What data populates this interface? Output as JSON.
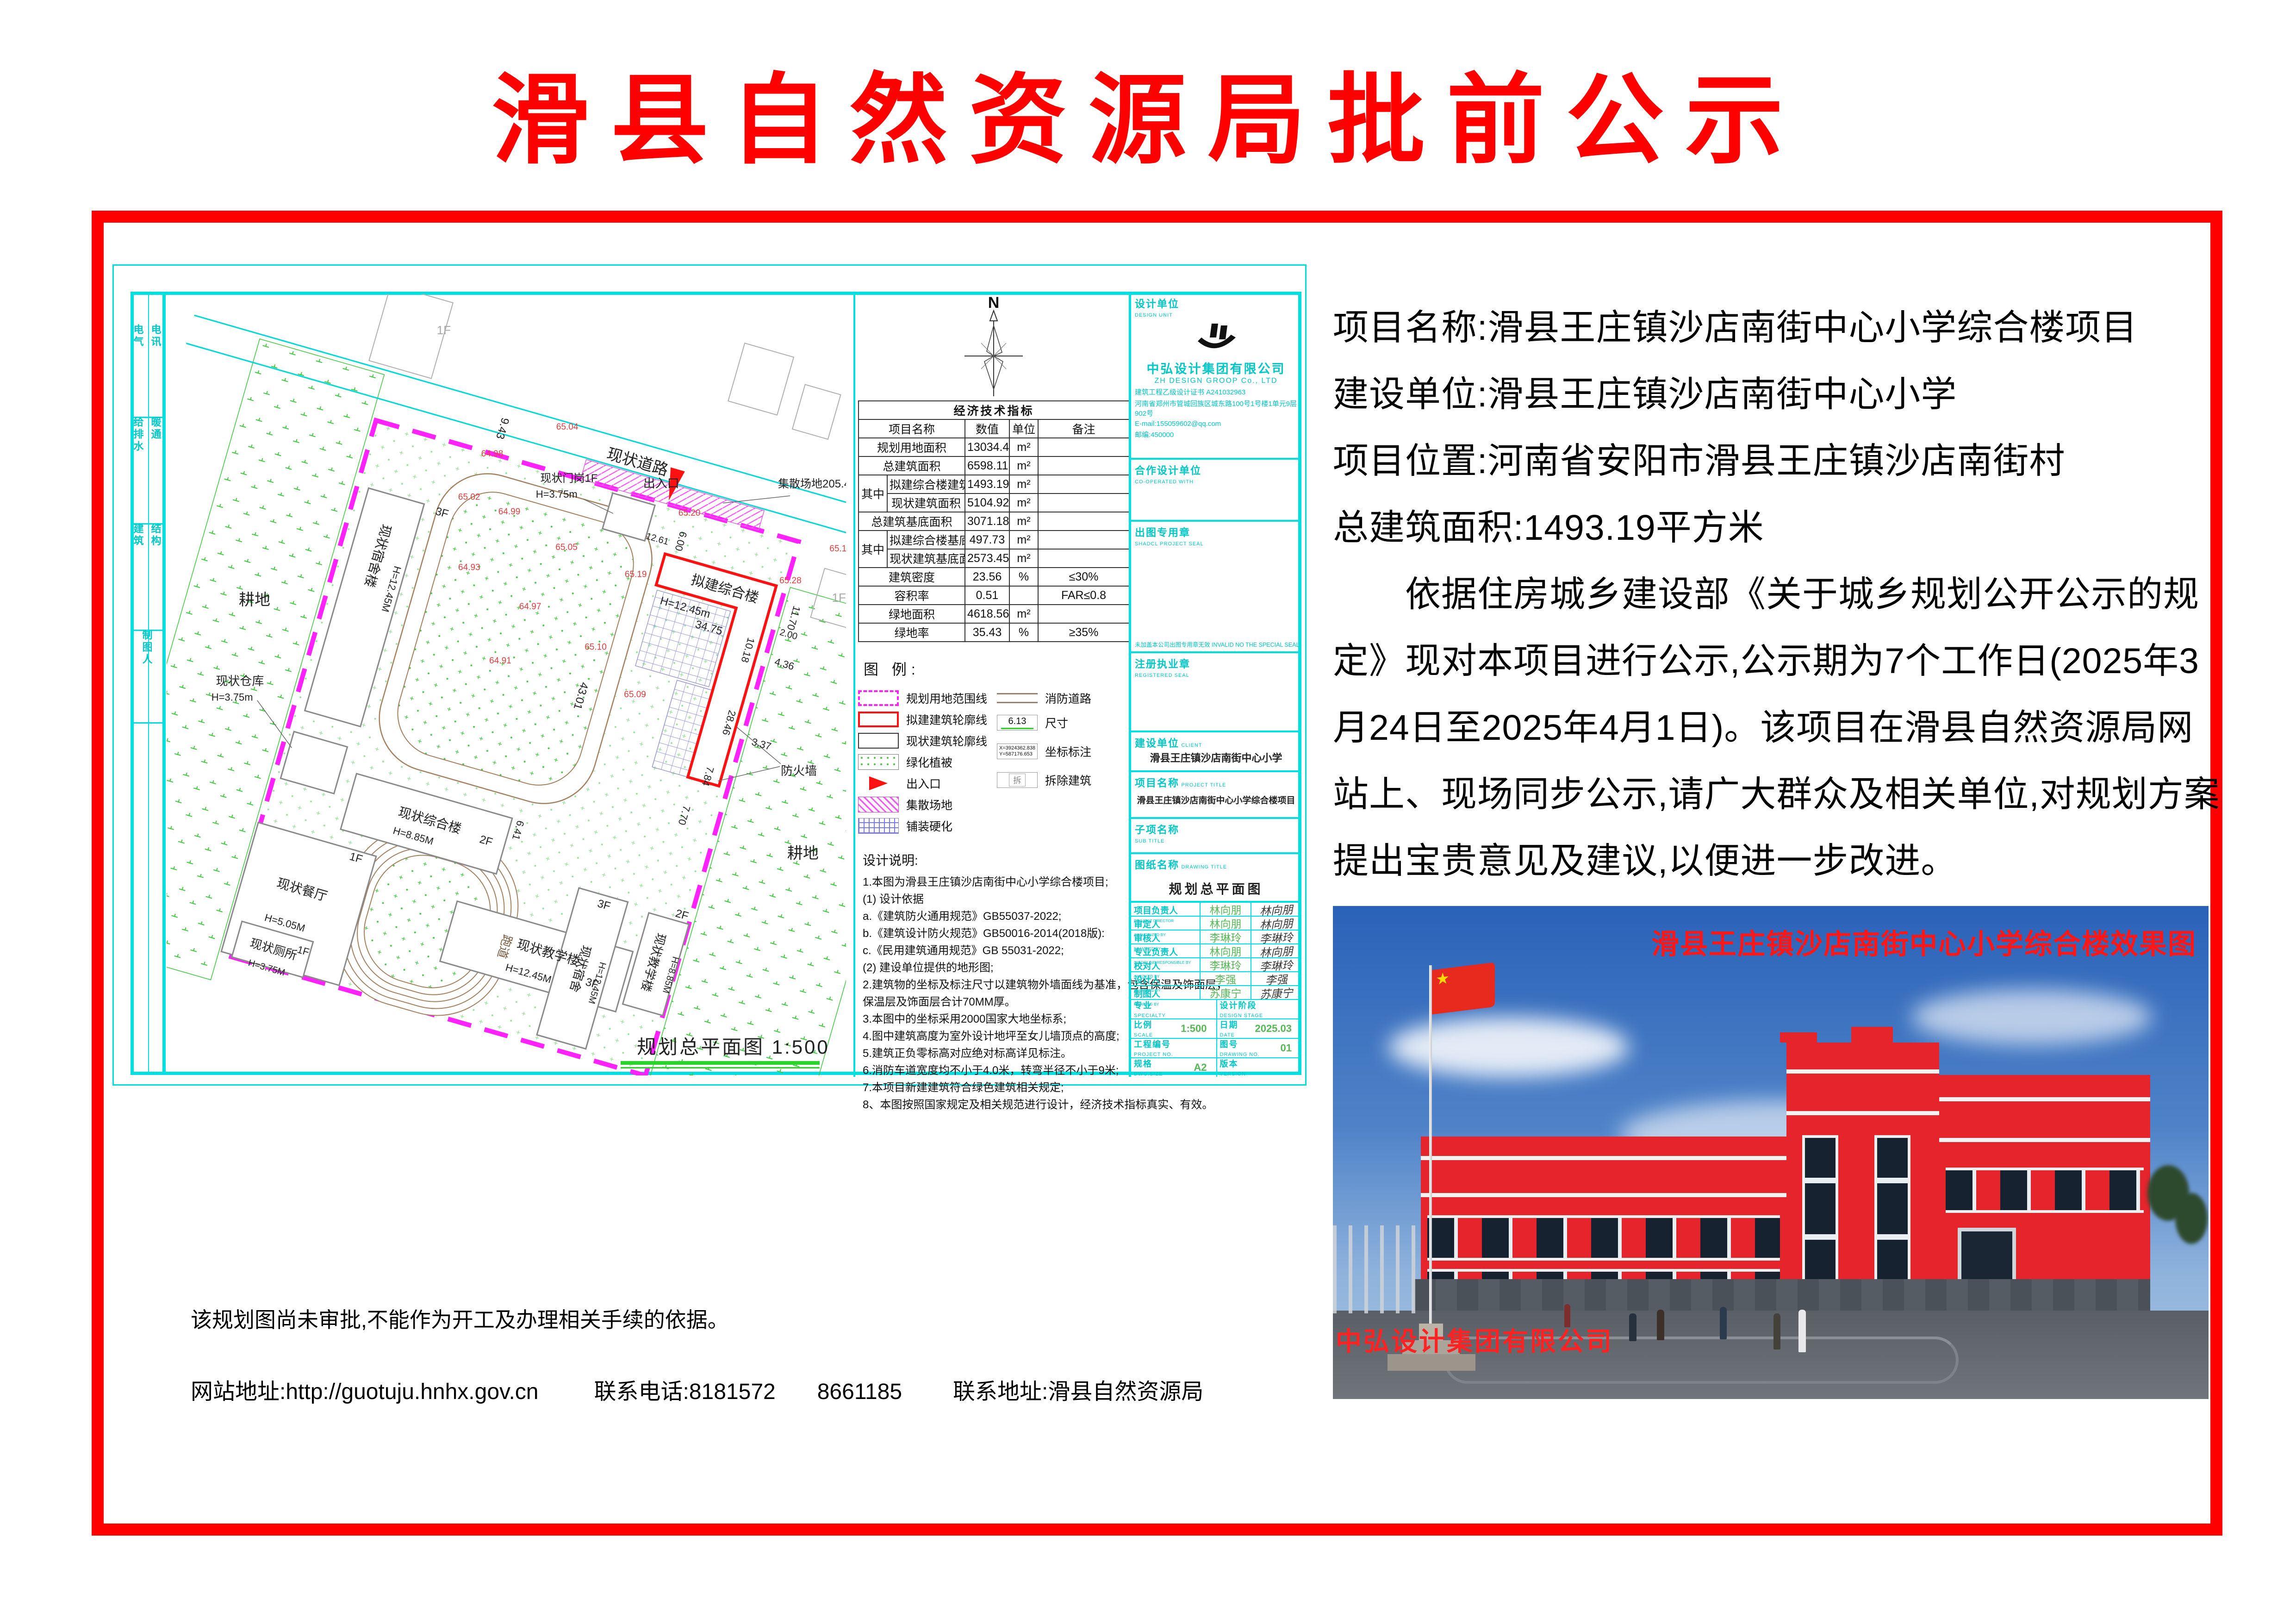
{
  "page": {
    "title": "滑县自然资源局批前公示"
  },
  "info": {
    "lines": [
      "项目名称:滑县王庄镇沙店南街中心小学综合楼项目",
      "建设单位:滑县王庄镇沙店南街中心小学",
      "项目位置:河南省安阳市滑县王庄镇沙店南街村",
      "总建筑面积:1493.19平方米",
      "　　依据住房城乡建设部《关于城乡规划公开公示的规",
      "定》现对本项目进行公示,公示期为7个工作日(2025年3",
      "月24日至2025年4月1日)。该项目在滑县自然资源局网",
      "站上、现场同步公示,请广大群众及相关单位,对规划方案",
      "提出宝贵意见及建议,以便进一步改进。"
    ]
  },
  "footer": {
    "disclaimer": "该规划图尚未审批,不能作为开工及办理相关手续的依据。",
    "website": "网站地址:http://guotuju.hnhx.gov.cn",
    "phone": "联系电话:8181572",
    "phone2": "8661185",
    "address": "联系地址:滑县自然资源局"
  },
  "sheet": {
    "side": {
      "a1": "电气",
      "a2": "电讯",
      "b1": "给排水",
      "b2": "暖通",
      "c1": "建筑",
      "c2": "结构",
      "d": "制图人"
    },
    "compass_n": "N",
    "table": {
      "title": "经济技术指标",
      "headers": {
        "name": "项目名称",
        "value": "数值",
        "unit": "单位",
        "note": "备注"
      },
      "rows": [
        {
          "group": "",
          "name": "规划用地面积",
          "value": "13034.49",
          "unit": "m²",
          "note": ""
        },
        {
          "group": "",
          "name": "总建筑面积",
          "value": "6598.11",
          "unit": "m²",
          "note": ""
        },
        {
          "group": "其中",
          "name": "拟建综合楼建筑面积",
          "value": "1493.19",
          "unit": "m²",
          "note": ""
        },
        {
          "group": "其中",
          "name": "现状建筑面积",
          "value": "5104.92",
          "unit": "m²",
          "note": ""
        },
        {
          "group": "",
          "name": "总建筑基底面积",
          "value": "3071.18",
          "unit": "m²",
          "note": ""
        },
        {
          "group": "其中",
          "name": "拟建综合楼基底面积",
          "value": "497.73",
          "unit": "m²",
          "note": ""
        },
        {
          "group": "其中",
          "name": "现状建筑基底面积",
          "value": "2573.45",
          "unit": "m²",
          "note": ""
        },
        {
          "group": "",
          "name": "建筑密度",
          "value": "23.56",
          "unit": "%",
          "note": "≤30%"
        },
        {
          "group": "",
          "name": "容积率",
          "value": "0.51",
          "unit": "",
          "note": "FAR≤0.8"
        },
        {
          "group": "",
          "name": "绿地面积",
          "value": "4618.56",
          "unit": "m²",
          "note": ""
        },
        {
          "group": "",
          "name": "绿地率",
          "value": "35.43",
          "unit": "%",
          "note": "≥35%"
        }
      ]
    },
    "legend": {
      "title": "图 例:",
      "l1": "规划用地范围线",
      "l2": "拟建建筑轮廓线",
      "l3": "现状建筑轮廓线",
      "l4": "绿化植被",
      "l5": "出入口",
      "l6": "集散场地",
      "l7": "铺装硬化",
      "r1": "消防道路",
      "r2": "尺寸",
      "r2v": "6.13",
      "r3": "坐标标注",
      "r3x": "X=3924362.838",
      "r3y": "Y=587176.653",
      "r4": "拆除建筑",
      "r4s": "拆"
    },
    "notes": {
      "title": "设计说明:",
      "lines": [
        "1.本图为滑县王庄镇沙店南街中心小学综合楼项目;",
        "(1) 设计依据",
        "a.《建筑防火通用规范》GB55037-2022;",
        "b.《建筑设计防火规范》GB50016-2014(2018版):",
        "c.《民用建筑通用规范》GB 55031-2022;",
        "(2) 建设单位提供的地形图;",
        "2.建筑物的坐标及标注尺寸以建筑物外墙面线为基准，包含保温及饰面层，",
        "保温层及饰面层合计70MM厚。",
        "3.本图中的坐标采用2000国家大地坐标系;",
        "4.图中建筑高度为室外设计地坪至女儿墙顶点的高度;",
        "5.建筑正负零标高对应绝对标高详见标注。",
        "6.消防车道宽度均不小于4.0米，转弯半径不小于9米;",
        "7.本项目新建建筑符合绿色建筑相关规定;",
        "8、本图按照国家规定及相关规范进行设计，经济技术指标真实、有效。"
      ]
    },
    "tb": {
      "du_l": "设计单位",
      "du_e": "DESIGN UNIT",
      "co": "中弘设计集团有限公司",
      "co_e": "ZH  DESIGN  GROOP Co.,  LTD",
      "cert": "建筑工程乙级设计证书  A241032963",
      "addr": "河南省郑州市管城回族区城东路100号1号楼1单元9层902号",
      "email": "E-mail:155059602@qq.com",
      "zip": "邮编:450000",
      "coop_l": "合作设计单位",
      "coop_e": "CO-OPERATED WITH",
      "seal_l": "出图专用章",
      "seal_e": "SHADCL PROJECT SEAL",
      "seal_note": "未加盖本公司出图专用章无效  INVALID NO THE SPECIAL SEAL",
      "reg_l": "注册执业章",
      "reg_e": "REGISTERED SEAL",
      "client_l": "建设单位",
      "client_e": "CLIENT",
      "client_v": "滑县王庄镇沙店南街中心小学",
      "proj_l": "项目名称",
      "proj_e": "PROJECT TITLE",
      "proj_v": "滑县王庄镇沙店南街中心小学综合楼项目",
      "sub_l": "子项名称",
      "sub_e": "SUB TITLE",
      "dwg_l": "图纸名称",
      "dwg_e": "DRAWING TITLE",
      "dwg_v": "规划总平面图",
      "rows": [
        {
          "l": "项目负责人",
          "e": "PROJECT DIRECTOR",
          "v": "林向朋"
        },
        {
          "l": "审定人",
          "e": "AUTHORIZED BY",
          "v": "林向朋"
        },
        {
          "l": "审核人",
          "e": "EXAMINED BY",
          "v": "李琳玲"
        },
        {
          "l": "专业负责人",
          "e": "DISCIPLINE RESPONSIBLE BY",
          "v": "林向朋"
        },
        {
          "l": "校对人",
          "e": "CHECKED BY",
          "v": "李琳玲"
        },
        {
          "l": "设计人",
          "e": "DESIGNED BY",
          "v": "李强"
        },
        {
          "l": "制图人",
          "e": "DRAWING BY",
          "v": "苏康宁"
        }
      ],
      "spec_l": "专业",
      "spec_e": "SPECIALTY",
      "stage_l": "设计阶段",
      "stage_e": "DESIGN STAGE",
      "scale_l": "比例",
      "scale_e": "SCALE",
      "scale_v": "1:500",
      "date_l": "日期",
      "date_e": "DATE",
      "date_v": "2025.03",
      "pno_l": "工程编号",
      "pno_e": "PROJECT NO.",
      "dno_l": "图号",
      "dno_e": "DRAWING NO.",
      "dno_v": "01",
      "size_l": "规格",
      "size_e": "DWG.SIZE",
      "size_v": "A2",
      "ver_l": "版本",
      "ver_e": "VERSION"
    },
    "plan": {
      "road": "现状道路",
      "entrance": "出入口",
      "gather": "集散场地205.40m²",
      "gate1": "现状门岗1F",
      "gate2": "H=3.75m",
      "proposed1": "拟建综合楼",
      "proposed2": "H=12.45m",
      "firewall": "防火墙",
      "dorm1": "现状宿舍楼",
      "dorm1h": "H=12.45M",
      "dorm1f": "3F",
      "wh1": "现状仓库",
      "wh2": "H=3.75m",
      "comp1": "现状综合楼",
      "comp1h": "H=8.85M",
      "comp1f": "2F",
      "dining1": "现状餐厅",
      "dining1f": "1F",
      "dining1h": "H=5.05M",
      "teach1": "现状教学楼",
      "teach1h": "H=12.45M",
      "teach1f": "3F",
      "teach2": "现状教学楼",
      "teach2h": "H=8.85M",
      "teach2f": "2F",
      "toilet1": "现状厕所",
      "toilet1f": "1F",
      "toilet1h": "H=3.75M",
      "dorm2": "现状宿舍",
      "dorm2f": "3F",
      "dorm2h": "H=12.45M",
      "track": "跑道",
      "farmland": "耕地",
      "n1": "1F",
      "d1": "9.43",
      "d2": "9.42",
      "d3": "6.00",
      "d4": "12.61",
      "d5": "34.75",
      "d6": "10.18",
      "d7": "11.70",
      "d8": "28.46",
      "d9": "7.84",
      "d10": "7.70",
      "d11": "4.36",
      "d12": "3.37",
      "d13": "2.00",
      "d14": "43.01",
      "d15": "6.41",
      "e1": "65.04",
      "e2": "64.98",
      "e3": "64.99",
      "e4": "65.02",
      "e5": "65.05",
      "e6": "65.19",
      "e7": "64.93",
      "e8": "64.97",
      "e9": "64.91",
      "e10": "65.10",
      "e11": "65.09",
      "e12": "65.20",
      "e13": "65.28",
      "e14": "65.17",
      "e15": "65.23",
      "title": "规划总平面图 1:500"
    }
  },
  "render": {
    "caption": "滑县王庄镇沙店南街中心小学综合楼效果图",
    "watermark": "中弘设计集团有限公司"
  }
}
